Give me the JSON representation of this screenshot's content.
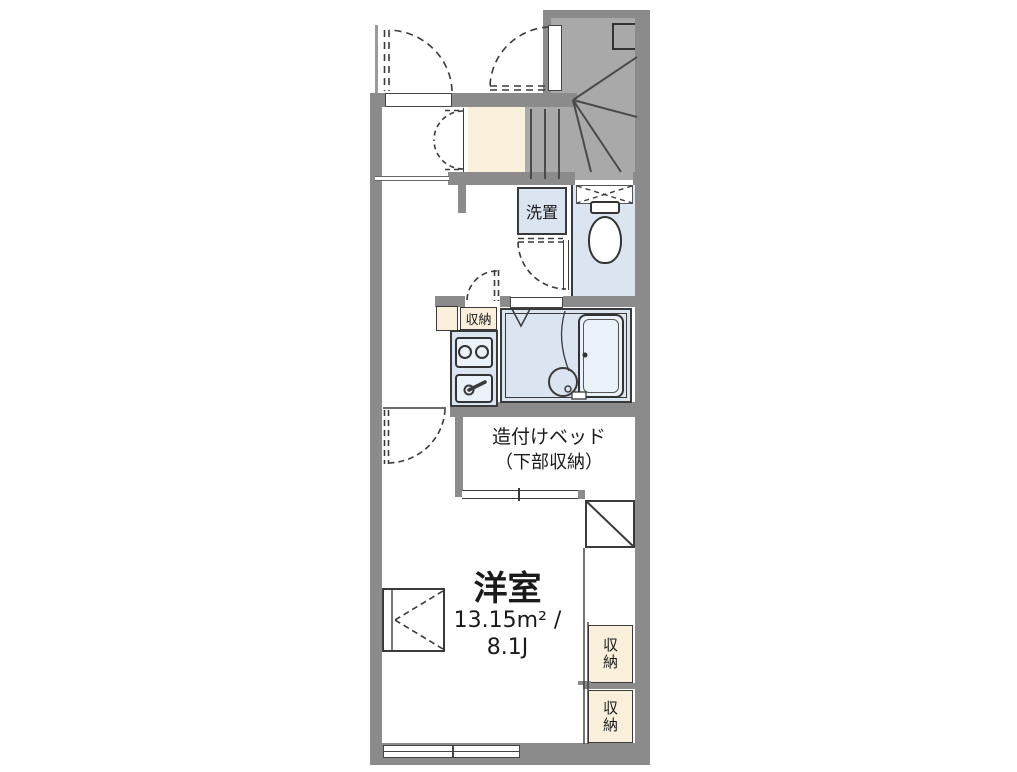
{
  "colors": {
    "wall": "#8b8b8b",
    "stair": "#a9a9a9",
    "cream": "#f9efda",
    "room_blue": "#dbe5f2",
    "fixture_blue": "#eaf1f9",
    "line": "#3a3a3a"
  },
  "labels": {
    "washer": "洗置",
    "kitchen_storage": "収納",
    "bed_name": "造付けベッド",
    "bed_sub": "（下部収納）",
    "room_name": "洋室",
    "room_area": "13.15m² /",
    "room_size": "8.1J",
    "closet_upper": "収納",
    "closet_lower": "収納"
  }
}
